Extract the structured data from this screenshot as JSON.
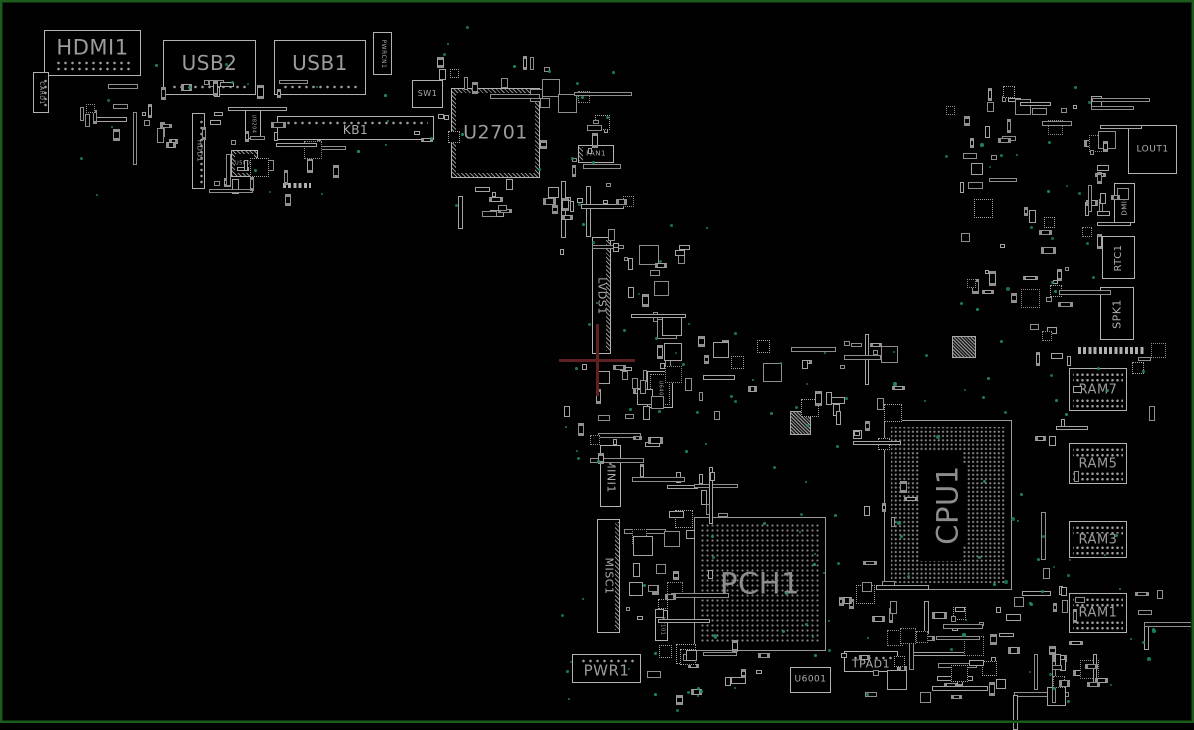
{
  "board": {
    "width": 1194,
    "height": 723,
    "background": "#010101",
    "outline_color": "#1e5c1e"
  },
  "colors": {
    "component_outline": "#b2b2b2",
    "label": "#aeaeae",
    "big_chip_label": "#8d8d8d",
    "bga_dot": "#848484",
    "via": "#1f8a66",
    "pad": "#9d9d9d",
    "crosshair": "#5e2020"
  },
  "components": [
    {
      "id": "HDMI1",
      "label": "HDMI1",
      "x": 44,
      "y": 30,
      "w": 97,
      "h": 46,
      "fs": 21,
      "dir": "h",
      "type": "connector",
      "pads": "bottom2",
      "ly": 38
    },
    {
      "id": "CARD1",
      "label": "CARD1",
      "x": 33,
      "y": 72,
      "w": 16,
      "h": 41,
      "fs": 6,
      "dir": "down",
      "type": "connector",
      "pads": "right"
    },
    {
      "id": "USB2",
      "label": "USB2",
      "x": 163,
      "y": 40,
      "w": 93,
      "h": 55,
      "fs": 20,
      "dir": "h",
      "type": "connector",
      "pads": "bottom",
      "ly": 42
    },
    {
      "id": "USB1",
      "label": "USB1",
      "x": 274,
      "y": 40,
      "w": 92,
      "h": 55,
      "fs": 20,
      "dir": "h",
      "type": "connector",
      "pads": "bottom",
      "ly": 42
    },
    {
      "id": "PWRCN1",
      "label": "PWRCN1",
      "x": 373,
      "y": 32,
      "w": 19,
      "h": 43,
      "fs": 6,
      "dir": "down",
      "type": "connector"
    },
    {
      "id": "SW1",
      "label": "SW1",
      "x": 412,
      "y": 80,
      "w": 31,
      "h": 28,
      "fs": 8,
      "dir": "h",
      "type": "chip"
    },
    {
      "id": "KB1",
      "label": "KB1",
      "x": 277,
      "y": 116,
      "w": 157,
      "h": 24,
      "fs": 12,
      "dir": "h",
      "type": "connector",
      "pads": "top",
      "ly": 60
    },
    {
      "id": "U2701",
      "label": "U2701",
      "x": 451,
      "y": 88,
      "w": 89,
      "h": 90,
      "fs": 19,
      "dir": "h",
      "type": "hatched"
    },
    {
      "id": "FAN1",
      "label": "FAN1",
      "x": 578,
      "y": 145,
      "w": 36,
      "h": 18,
      "fs": 7,
      "dir": "h",
      "type": "chip",
      "pads": "left-h"
    },
    {
      "id": "HDD1",
      "label": "HDD1",
      "x": 192,
      "y": 113,
      "w": 13,
      "h": 76,
      "fs": 7,
      "dir": "down",
      "type": "connector",
      "pads": "right"
    },
    {
      "id": "U8204",
      "label": "U8204",
      "x": 245,
      "y": 108,
      "w": 16,
      "h": 31,
      "fs": 5,
      "dir": "down",
      "type": "chip"
    },
    {
      "id": "U5801",
      "label": "U5801",
      "x": 231,
      "y": 150,
      "w": 27,
      "h": 27,
      "fs": 5,
      "dir": "h",
      "type": "hatched-sm"
    },
    {
      "id": "LVDS1",
      "label": "LVDS1",
      "x": 592,
      "y": 237,
      "w": 19,
      "h": 117,
      "fs": 11,
      "dir": "down",
      "type": "connector",
      "pads": "right-hatch"
    },
    {
      "id": "MINI1",
      "label": "MINI1",
      "x": 600,
      "y": 445,
      "w": 21,
      "h": 62,
      "fs": 11,
      "dir": "down",
      "type": "connector"
    },
    {
      "id": "MISC1",
      "label": "MISC1",
      "x": 597,
      "y": 519,
      "w": 23,
      "h": 114,
      "fs": 11,
      "dir": "down",
      "type": "connector",
      "pads": "right-hatch"
    },
    {
      "id": "PWR1",
      "label": "PWR1",
      "x": 572,
      "y": 654,
      "w": 69,
      "h": 29,
      "fs": 15,
      "dir": "h",
      "type": "connector",
      "pads": "top",
      "ly": 60
    },
    {
      "id": "X2101",
      "label": "X2101",
      "x": 655,
      "y": 610,
      "w": 13,
      "h": 31,
      "fs": 5,
      "dir": "down",
      "type": "chip"
    },
    {
      "id": "U6401",
      "label": "U6401",
      "x": 647,
      "y": 371,
      "w": 26,
      "h": 37,
      "fs": 5,
      "dir": "down",
      "type": "chip-pads"
    },
    {
      "id": "PCH1",
      "label": "PCH1",
      "x": 694,
      "y": 517,
      "w": 132,
      "h": 134,
      "fs": 29,
      "dir": "h",
      "type": "bga",
      "pitch": 5
    },
    {
      "id": "CPU1",
      "label": "CPU1",
      "x": 884,
      "y": 420,
      "w": 128,
      "h": 170,
      "fs": 29,
      "dir": "up",
      "type": "bga",
      "pitch": 4.3,
      "labelbg": true
    },
    {
      "id": "U6001",
      "label": "U6001",
      "x": 790,
      "y": 667,
      "w": 41,
      "h": 26,
      "fs": 9,
      "dir": "h",
      "type": "chip"
    },
    {
      "id": "TPAD1",
      "label": "TPAD1",
      "x": 844,
      "y": 651,
      "w": 54,
      "h": 21,
      "fs": 11,
      "dir": "h",
      "type": "connector",
      "pads": "top",
      "ly": 62
    },
    {
      "id": "LOUT1",
      "label": "LOUT1",
      "x": 1128,
      "y": 125,
      "w": 49,
      "h": 49,
      "fs": 9,
      "dir": "h",
      "type": "chip"
    },
    {
      "id": "DMIC2",
      "label": "DMIC2",
      "x": 1114,
      "y": 183,
      "w": 21,
      "h": 40,
      "fs": 7,
      "dir": "up",
      "type": "chip"
    },
    {
      "id": "RTC1",
      "label": "RTC1",
      "x": 1102,
      "y": 236,
      "w": 33,
      "h": 43,
      "fs": 10,
      "dir": "up",
      "type": "chip"
    },
    {
      "id": "SPK1",
      "label": "SPK1",
      "x": 1100,
      "y": 287,
      "w": 34,
      "h": 53,
      "fs": 11,
      "dir": "up",
      "type": "chip"
    },
    {
      "id": "RAM7",
      "label": "RAM7",
      "x": 1069,
      "y": 368,
      "w": 58,
      "h": 43,
      "fs": 13,
      "dir": "h",
      "type": "ram"
    },
    {
      "id": "RAM5",
      "label": "RAM5",
      "x": 1069,
      "y": 443,
      "w": 58,
      "h": 41,
      "fs": 13,
      "dir": "h",
      "type": "ram"
    },
    {
      "id": "RAM3",
      "label": "RAM3",
      "x": 1069,
      "y": 521,
      "w": 58,
      "h": 37,
      "fs": 13,
      "dir": "h",
      "type": "ram"
    },
    {
      "id": "RAM1",
      "label": "RAM1",
      "x": 1069,
      "y": 593,
      "w": 58,
      "h": 40,
      "fs": 13,
      "dir": "h",
      "type": "ram"
    }
  ],
  "decor": {
    "hatch_blocks": [
      {
        "x": 952,
        "y": 336,
        "w": 24,
        "h": 22
      },
      {
        "x": 790,
        "y": 411,
        "w": 21,
        "h": 24
      },
      {
        "x": 336,
        "y": 260,
        "w": 0,
        "h": 0
      }
    ],
    "pad_rows": [
      {
        "x": 1078,
        "y": 347,
        "w": 66,
        "h": 7
      },
      {
        "x": 283,
        "y": 183,
        "w": 28,
        "h": 5
      }
    ],
    "crosshair": {
      "x": 597,
      "y": 360,
      "arm_h": 38,
      "arm_v": 36,
      "thickness": 3
    }
  },
  "clusters": [
    {
      "x": 84,
      "y": 80,
      "w": 200,
      "h": 60,
      "n": 28,
      "seed": 1
    },
    {
      "x": 205,
      "y": 140,
      "w": 140,
      "h": 58,
      "n": 20,
      "seed": 2
    },
    {
      "x": 430,
      "y": 55,
      "w": 130,
      "h": 40,
      "n": 13,
      "seed": 3
    },
    {
      "x": 540,
      "y": 85,
      "w": 70,
      "h": 115,
      "n": 15,
      "seed": 4
    },
    {
      "x": 442,
      "y": 178,
      "w": 160,
      "h": 36,
      "n": 17,
      "seed": 5
    },
    {
      "x": 560,
      "y": 196,
      "w": 120,
      "h": 58,
      "n": 10,
      "seed": 6
    },
    {
      "x": 613,
      "y": 240,
      "w": 80,
      "h": 128,
      "n": 20,
      "seed": 7
    },
    {
      "x": 560,
      "y": 362,
      "w": 120,
      "h": 98,
      "n": 18,
      "seed": 8
    },
    {
      "x": 626,
      "y": 340,
      "w": 90,
      "h": 78,
      "n": 9,
      "seed": 9
    },
    {
      "x": 630,
      "y": 430,
      "w": 90,
      "h": 88,
      "n": 15,
      "seed": 10
    },
    {
      "x": 622,
      "y": 520,
      "w": 88,
      "h": 118,
      "n": 20,
      "seed": 11
    },
    {
      "x": 642,
      "y": 640,
      "w": 120,
      "h": 58,
      "n": 16,
      "seed": 12
    },
    {
      "x": 690,
      "y": 332,
      "w": 200,
      "h": 78,
      "n": 24,
      "seed": 13
    },
    {
      "x": 830,
      "y": 350,
      "w": 80,
      "h": 168,
      "n": 15,
      "seed": 14
    },
    {
      "x": 836,
      "y": 560,
      "w": 58,
      "h": 98,
      "n": 13,
      "seed": 15
    },
    {
      "x": 840,
      "y": 592,
      "w": 180,
      "h": 108,
      "n": 27,
      "seed": 16
    },
    {
      "x": 1020,
      "y": 560,
      "w": 58,
      "h": 138,
      "n": 11,
      "seed": 17
    },
    {
      "x": 940,
      "y": 85,
      "w": 170,
      "h": 58,
      "n": 27,
      "seed": 18
    },
    {
      "x": 960,
      "y": 150,
      "w": 150,
      "h": 98,
      "n": 24,
      "seed": 19
    },
    {
      "x": 960,
      "y": 252,
      "w": 120,
      "h": 88,
      "n": 18,
      "seed": 20
    },
    {
      "x": 1080,
      "y": 120,
      "w": 40,
      "h": 118,
      "n": 7,
      "seed": 21
    },
    {
      "x": 1030,
      "y": 352,
      "w": 50,
      "h": 286,
      "n": 11,
      "seed": 22
    },
    {
      "x": 1130,
      "y": 342,
      "w": 28,
      "h": 296,
      "n": 9,
      "seed": 23
    },
    {
      "x": 405,
      "y": 100,
      "w": 50,
      "h": 40,
      "n": 5,
      "seed": 24
    },
    {
      "x": 152,
      "y": 116,
      "w": 24,
      "h": 32,
      "n": 3,
      "seed": 25
    },
    {
      "x": 60,
      "y": 85,
      "w": 40,
      "h": 30,
      "n": 4,
      "seed": 26
    },
    {
      "x": 1045,
      "y": 640,
      "w": 60,
      "h": 58,
      "n": 13,
      "seed": 27
    },
    {
      "x": 900,
      "y": 610,
      "w": 120,
      "h": 78,
      "n": 15,
      "seed": 28
    }
  ],
  "via_clusters": [
    {
      "x": 80,
      "y": 80,
      "w": 400,
      "h": 120,
      "n": 15,
      "seed": 101
    },
    {
      "x": 430,
      "y": 55,
      "w": 200,
      "h": 150,
      "n": 12,
      "seed": 102
    },
    {
      "x": 555,
      "y": 190,
      "w": 160,
      "h": 280,
      "n": 18,
      "seed": 103
    },
    {
      "x": 560,
      "y": 430,
      "w": 160,
      "h": 280,
      "n": 15,
      "seed": 104
    },
    {
      "x": 620,
      "y": 620,
      "w": 250,
      "h": 80,
      "n": 12,
      "seed": 105
    },
    {
      "x": 680,
      "y": 330,
      "w": 220,
      "h": 190,
      "n": 18,
      "seed": 106
    },
    {
      "x": 830,
      "y": 340,
      "w": 190,
      "h": 260,
      "n": 15,
      "seed": 107
    },
    {
      "x": 690,
      "y": 520,
      "w": 340,
      "h": 180,
      "n": 18,
      "seed": 108
    },
    {
      "x": 940,
      "y": 85,
      "w": 180,
      "h": 260,
      "n": 20,
      "seed": 109
    },
    {
      "x": 1020,
      "y": 340,
      "w": 130,
      "h": 300,
      "n": 15,
      "seed": 110
    },
    {
      "x": 1040,
      "y": 620,
      "w": 140,
      "h": 90,
      "n": 8,
      "seed": 111
    },
    {
      "x": 390,
      "y": 20,
      "w": 80,
      "h": 60,
      "n": 3,
      "seed": 112
    },
    {
      "x": 140,
      "y": 40,
      "w": 120,
      "h": 50,
      "n": 3,
      "seed": 113
    },
    {
      "x": 980,
      "y": 555,
      "w": 100,
      "h": 60,
      "n": 5,
      "seed": 114
    }
  ]
}
